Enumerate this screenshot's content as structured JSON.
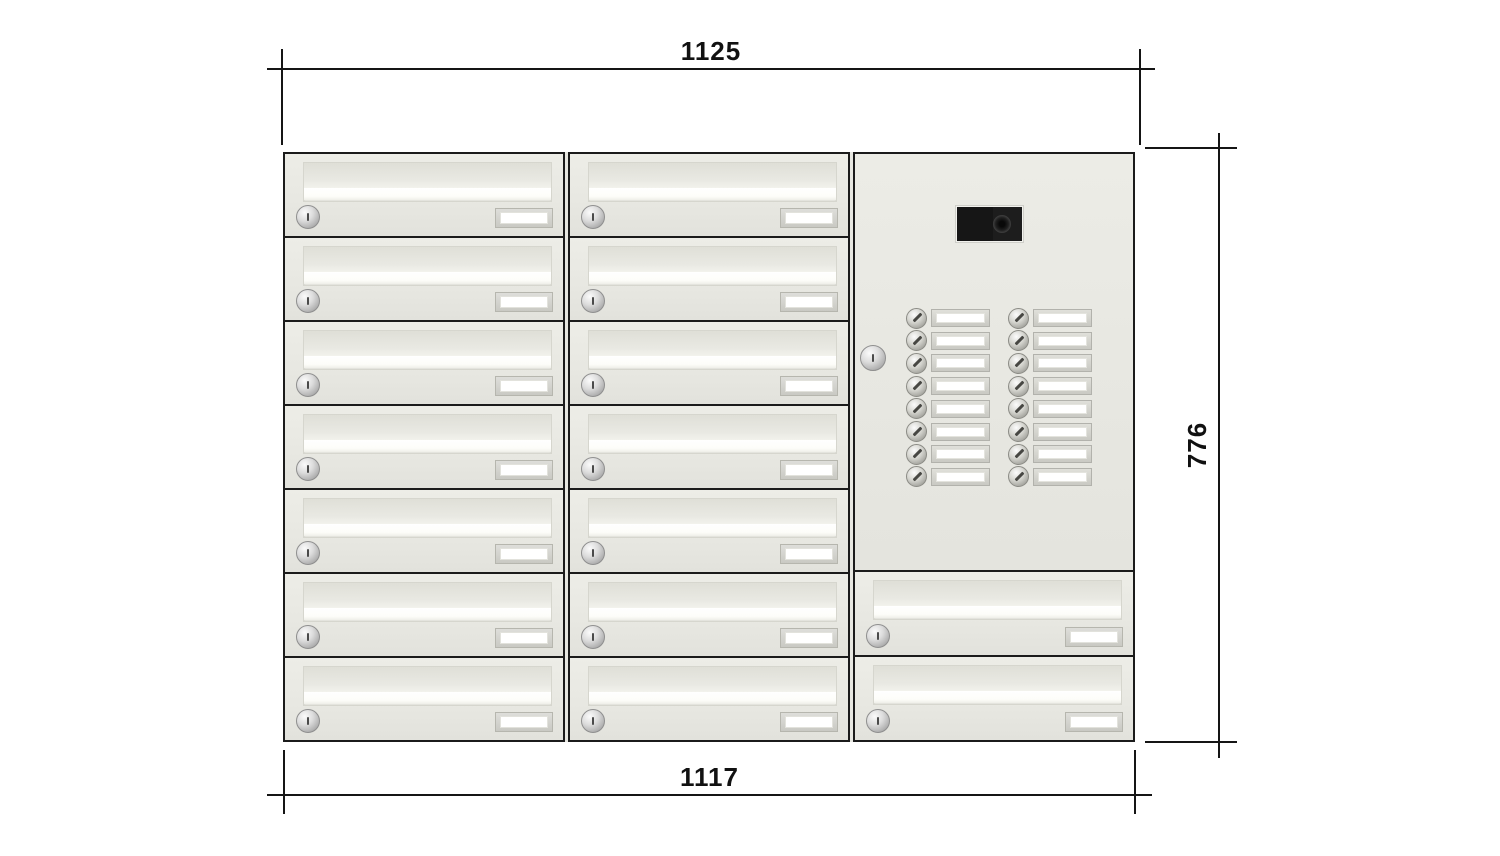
{
  "drawing": {
    "dimensions": {
      "top_width": "1125",
      "bottom_width": "1117",
      "height": "776"
    }
  },
  "cabinet": {
    "columns": [
      {
        "name": "left-column",
        "mailbox_count": 7
      },
      {
        "name": "middle-column",
        "mailbox_count": 7
      },
      {
        "name": "right-column",
        "has_intercom": true,
        "mailbox_count": 2
      }
    ],
    "mailbox_features": [
      "letter-slot",
      "cylinder-lock",
      "name-plate"
    ],
    "intercom": {
      "camera": "camera-module",
      "lock": "cylinder-lock",
      "bell_button_columns": 2,
      "bell_button_rows": 8,
      "bell_button_total": 16
    },
    "colors": {
      "body": "#e8e8e2",
      "outline": "#1b1b1b",
      "metal": "#c6c6c0",
      "plate_window": "#ffffff",
      "camera_body": "#1d1d1d",
      "dimension_lines": "#151515"
    }
  }
}
